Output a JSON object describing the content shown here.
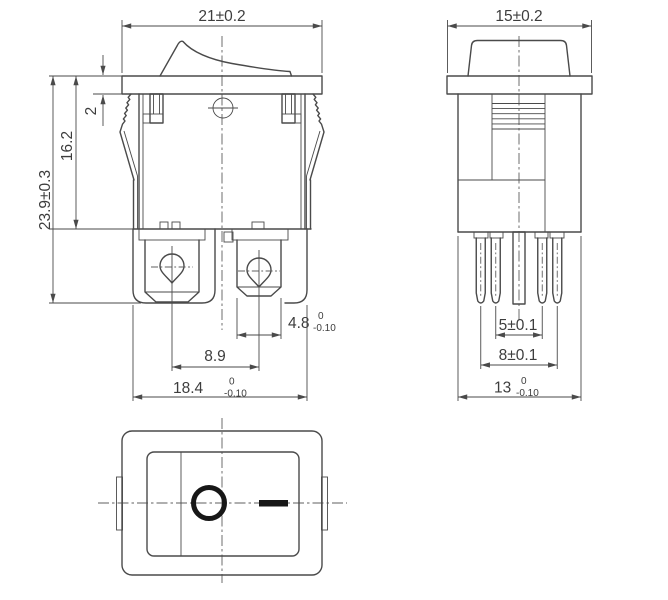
{
  "drawing": {
    "type": "rocker-switch-dimension-drawing",
    "views": {
      "front": "front view",
      "side": "side view",
      "bottom": "top view"
    }
  },
  "dims": {
    "front_width": "21±0.2",
    "side_width": "15±0.2",
    "flange_thickness": "2",
    "body_height": "16.2",
    "total_height": "23.9±0.3",
    "terminal_width": "4.8",
    "terminal_width_tol_upper": "0",
    "terminal_width_tol_lower": "-0.10",
    "terminal_pitch": "8.9",
    "front_base_width": "18.4",
    "front_base_tol_upper": "0",
    "front_base_tol_lower": "-0.10",
    "pin_pitch_inner": "5±0.1",
    "pin_pitch_outer": "8±0.1",
    "side_base_width": "13",
    "side_base_tol_upper": "0",
    "side_base_tol_lower": "-0.10"
  },
  "markings": {
    "off_symbol": "O",
    "on_symbol": "—"
  }
}
